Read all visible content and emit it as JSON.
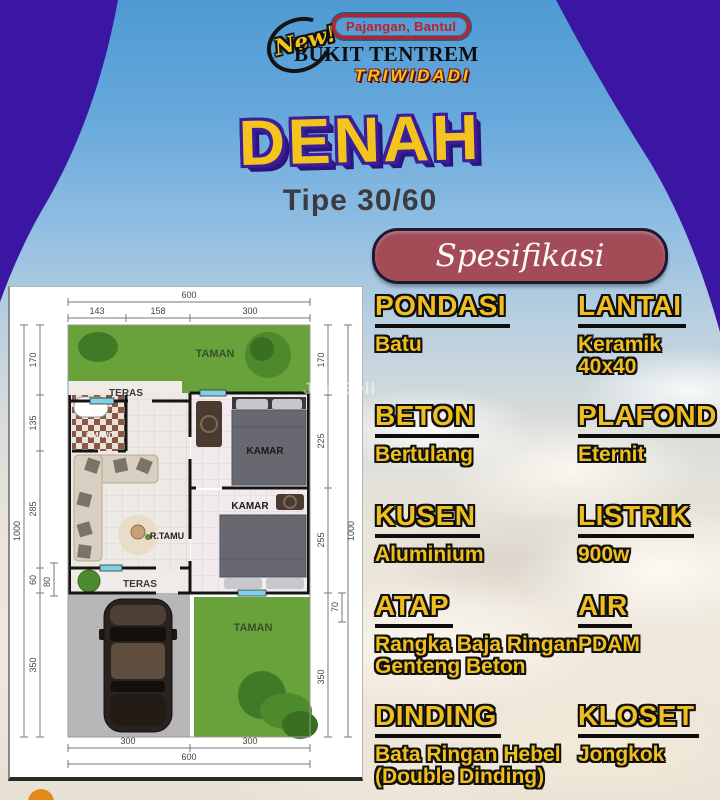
{
  "logo": {
    "new_script": "New!",
    "badge": "Pajangan, Bantul",
    "name": "BUKIT TENTREM",
    "location": "TRIWIDADI"
  },
  "title": {
    "main": "DENAH",
    "subtitle": "Tipe 30/60"
  },
  "spec": {
    "heading": "Spesifikasi",
    "items": [
      {
        "term": "PONDASI",
        "value": "Batu"
      },
      {
        "term": "LANTAI",
        "value": "Keramik 40x40"
      },
      {
        "term": "BETON",
        "value": "Bertulang"
      },
      {
        "term": "PLAFOND",
        "value": "Eternit"
      },
      {
        "term": "KUSEN",
        "value": "Aluminium"
      },
      {
        "term": "LISTRIK",
        "value": "900w"
      },
      {
        "term": "ATAP",
        "value": "Rangka Baja Ringan Genteng Beton"
      },
      {
        "term": "AIR",
        "value": "PDAM"
      },
      {
        "term": "DINDING",
        "value": "Bata Ringan Hebel (Double Dinding)"
      },
      {
        "term": "KLOSET",
        "value": "Jongkok"
      }
    ]
  },
  "floorplan": {
    "labels": {
      "taman_top": "TAMAN",
      "teras_top": "TERAS",
      "kmwc": "KM/WC",
      "kamar1": "KAMAR",
      "rtamu": "R.TAMU",
      "kamar2": "KAMAR",
      "teras_bottom": "TERAS",
      "taman_bottom": "TAMAN"
    },
    "dims": {
      "top_total": "600",
      "top_segments": [
        "143",
        "158",
        "300"
      ],
      "left_total": "1000",
      "left_segments": [
        "170",
        "135",
        "285",
        "60",
        "350"
      ],
      "left_inner": "80",
      "right_total": "1000",
      "right_segments": [
        "170",
        "225",
        "255",
        "70",
        "350"
      ],
      "bottom_total": "600",
      "bottom_segments": [
        "300",
        "300"
      ]
    }
  },
  "watermark": "JualBeli",
  "colors": {
    "accent_yellow": "#f0bf1d",
    "title_purple": "#3b1e9a",
    "banner_maroon": "#a34b57",
    "badge_red": "#bf1f27",
    "grass_green": "#69a23b",
    "sky_blue": "#4f9ad4"
  }
}
